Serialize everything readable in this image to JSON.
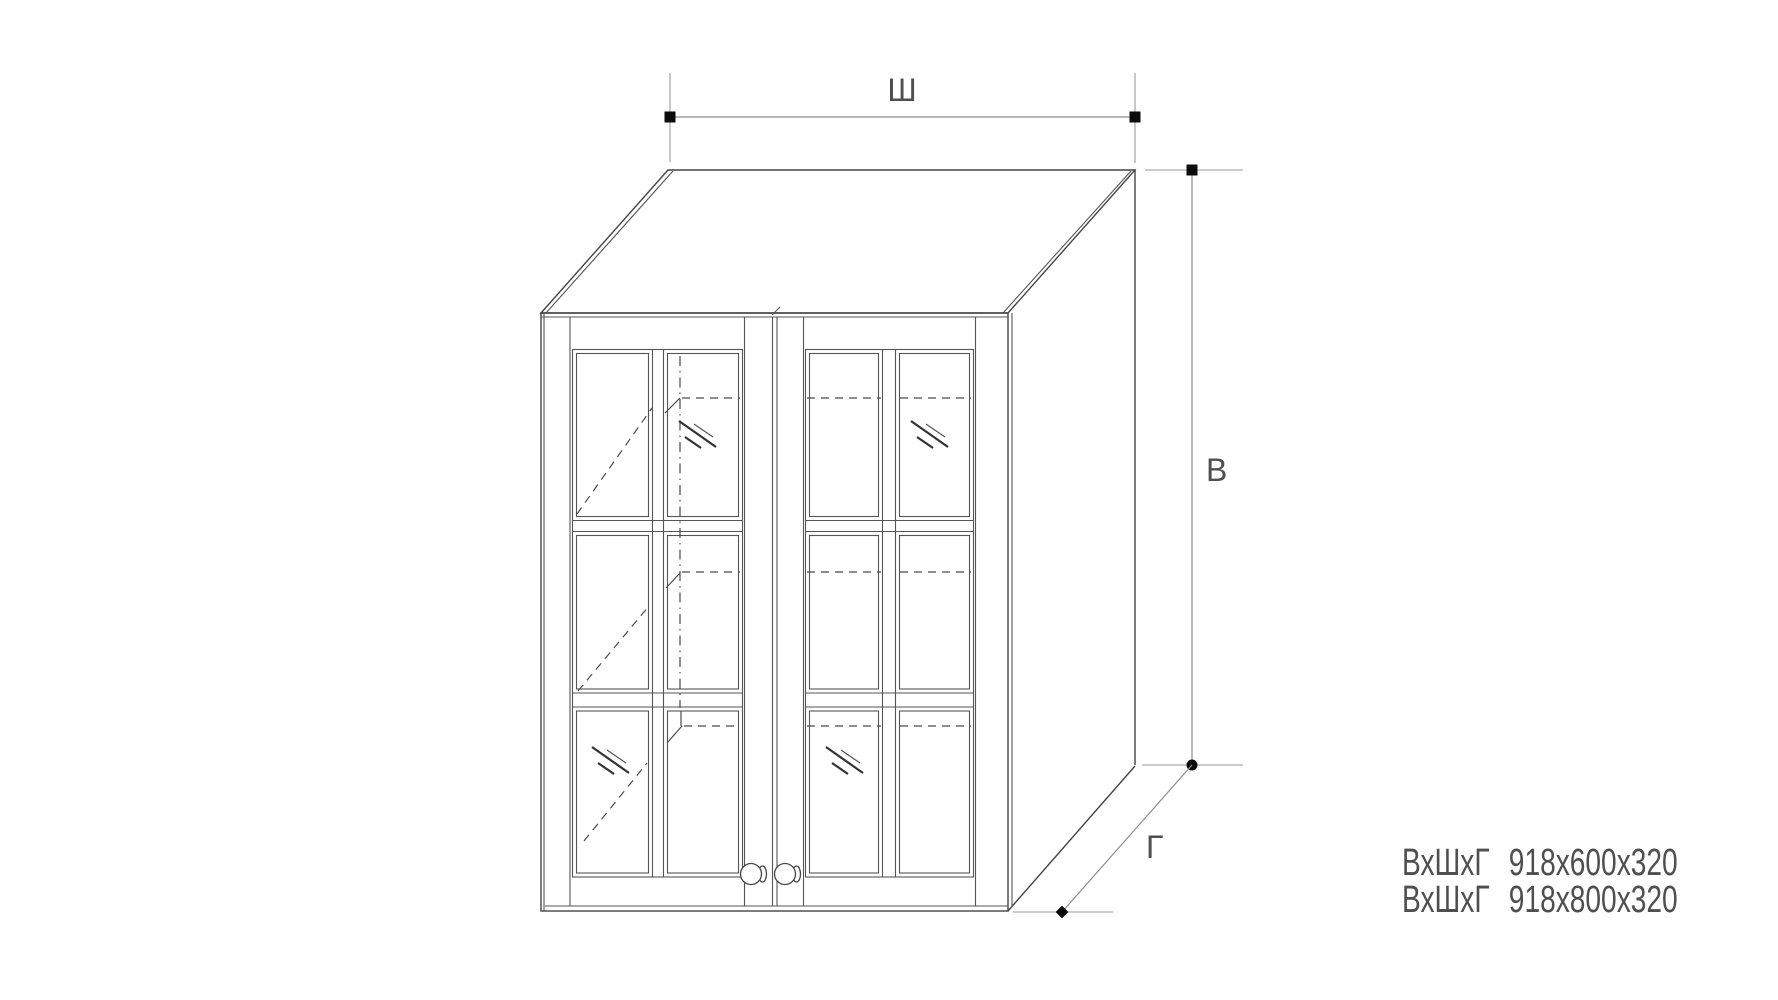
{
  "diagram": {
    "kind": "cabinet-technical-drawing",
    "description": "Wall cabinet with two glass doors, 2x3 panes per door, shown in oblique projection with dimension lines",
    "dimension_labels": {
      "width": "Ш",
      "height": "В",
      "depth": "Г"
    },
    "specs": [
      {
        "label": "ВхШхГ",
        "value": "918х600х320"
      },
      {
        "label": "ВхШхГ",
        "value": "918х800х320"
      }
    ],
    "colors": {
      "background": "#ffffff",
      "outline": "#444444",
      "detail": "#555555",
      "hidden_lines": "#4a4a4a",
      "dimension_lines": "#8d8d8d",
      "markers": "#0b0b0b",
      "text": "#4f4f4f"
    }
  }
}
